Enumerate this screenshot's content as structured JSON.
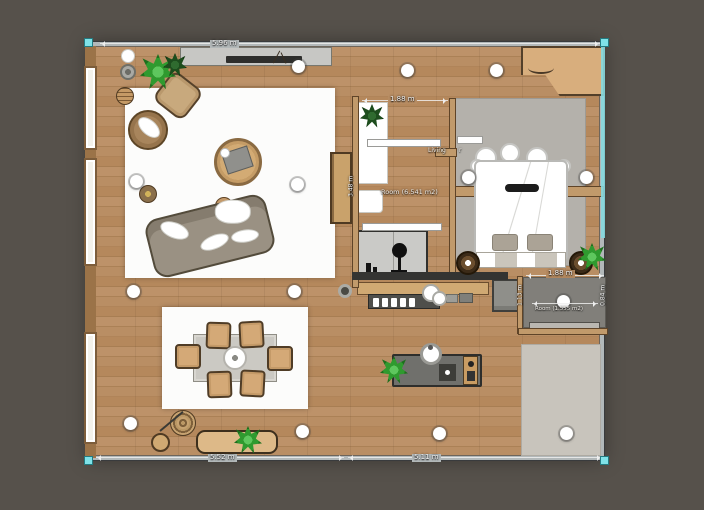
{
  "view": {
    "type": "floor-plan-editor",
    "mode": "2D top-down",
    "selection_present": true
  },
  "colors": {
    "canvas_background": "#56514b",
    "floor_wood": "#b78c62",
    "outer_wall_gray": "#b2b8b9",
    "selection_teal": "#7fe2e8",
    "interior_wall_tan": "#c19a6b",
    "rug_white": "#fcfcfb",
    "bedroom_rug_gray": "#b4b1ab",
    "bottom_rug_gray": "#c8c4bc",
    "plant_green": "#2f9a2f",
    "dimension_text": "#f3f3f3"
  },
  "dimensions": {
    "top_width": "5.96 m",
    "bottom_left_width": "5.52 m",
    "bottom_right_width": "5.11 m",
    "study_width": "1.88 m",
    "study_height": "3.48 m",
    "storage_width": "1.88 m",
    "storage_left_height": "1.13 m",
    "storage_right_height": "0.84 m"
  },
  "room_labels": {
    "study": "Room (6.541 m2)",
    "storage": "Room (1.555 m2)",
    "living_partial_left": "Living",
    "living_partial_right": "r"
  },
  "furniture_inventory": [
    "tv-console",
    "tv",
    "decor-branch",
    "potted-plants",
    "armchair",
    "rattan-chair",
    "striped-side-table",
    "round-coffee-table",
    "tray",
    "sofa",
    "pillows",
    "sphere-side-table",
    "round-side-table",
    "tall-cabinet",
    "dining-table",
    "dining-chairs",
    "centerpiece",
    "entry-bench",
    "round-stool",
    "round-woven-rug",
    "desk",
    "desk-plant",
    "small-table",
    "closet-with-lamp",
    "kitchen-counter",
    "dish-shelf",
    "sink",
    "fridge",
    "kitchen-island",
    "island-sink",
    "cutting-board",
    "cooktop-module",
    "bed",
    "bed-pillows",
    "nightstands",
    "corner-wardrobe",
    "storage-step",
    "area-rugs",
    "ceiling-lights",
    "windows",
    "doors"
  ],
  "ceiling_lights_count": 14
}
